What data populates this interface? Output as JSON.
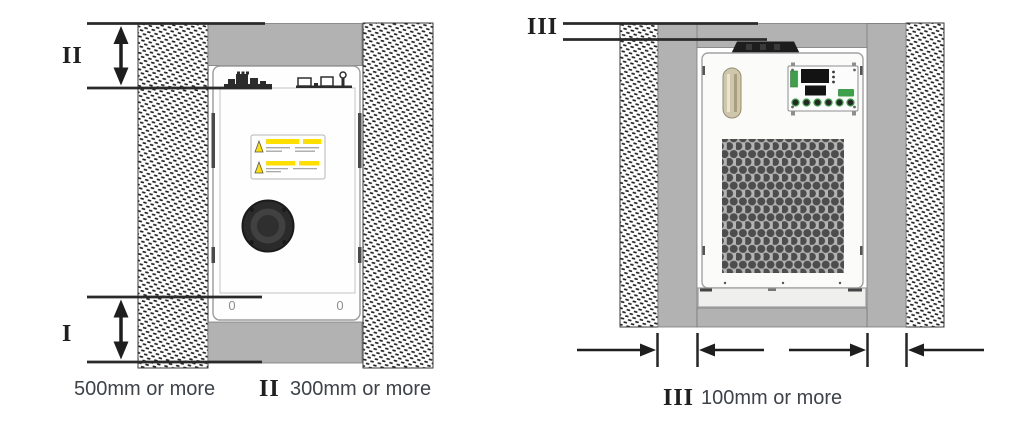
{
  "left_view": {
    "top_gap_marker": "II",
    "front_gap_marker": "I",
    "front_gap_caption": "500mm or more",
    "top_gap_caption_marker": "II",
    "top_gap_caption": "300mm or more",
    "foot_slots": [
      "0",
      "0"
    ]
  },
  "right_view": {
    "side_gap_marker": "III",
    "side_gap_caption_marker": "III",
    "side_gap_caption": "100mm or more"
  },
  "colors": {
    "wall_gray": "#b2b2b2",
    "outline_dark": "#2a2a2a",
    "caption_text": "#3e434a",
    "warning_yellow": "#ffdf00",
    "panel_green": "#3ea04a",
    "display_black": "#131313"
  }
}
